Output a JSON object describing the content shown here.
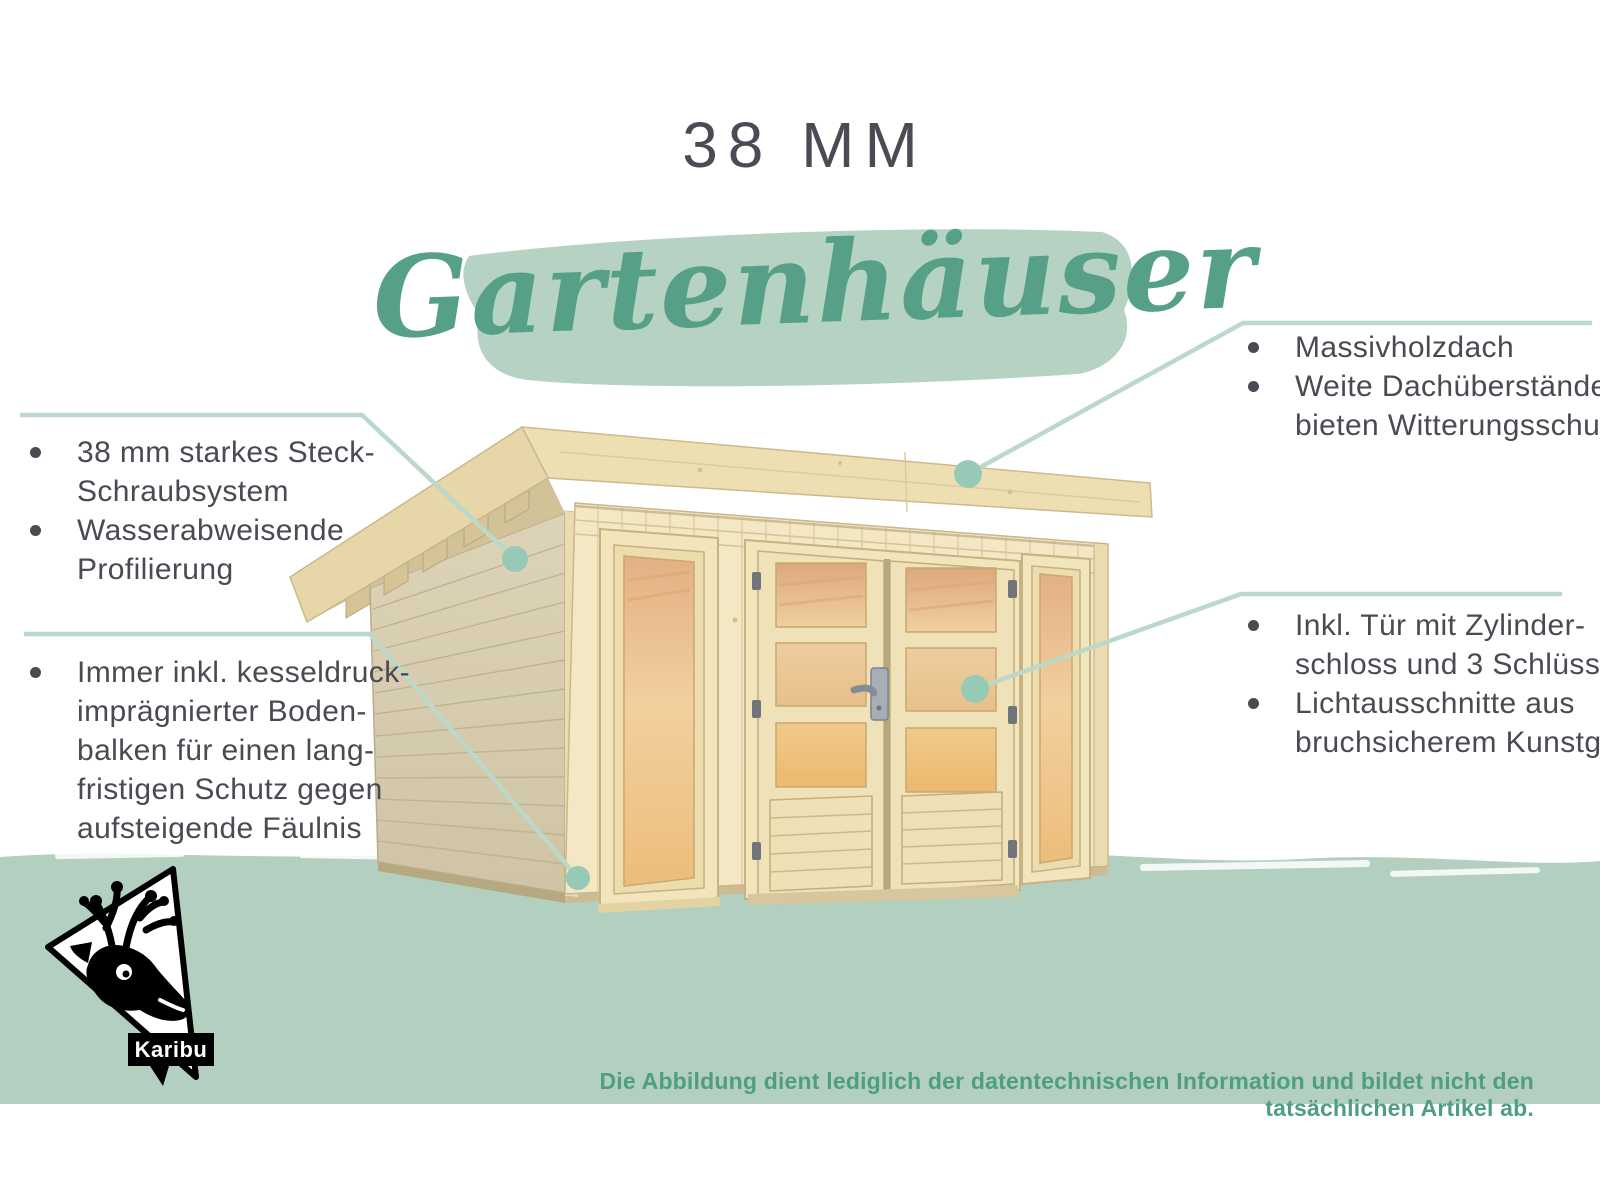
{
  "header": {
    "size_label": "38 MM",
    "script_title": "Gartenhäuser"
  },
  "callouts": {
    "top_left": {
      "lines": [
        "38 mm starkes Steck-",
        "Schraubsystem",
        "Wasserabweisende",
        "Profilierung"
      ]
    },
    "bottom_left": {
      "lines": [
        "Immer inkl. kesseldruck-",
        "imprägnierter Boden-",
        "balken für einen lang-",
        "fristigen Schutz gegen",
        "aufsteigende Fäulnis"
      ]
    },
    "top_right": {
      "lines": [
        "Massivholzdach",
        "Weite Dachüberstände",
        "bieten Witterungsschutz"
      ]
    },
    "bottom_right": {
      "lines": [
        "Inkl. Tür mit Zylinder-",
        "schloss und 3 Schlüsseln",
        "Lichtausschnitte aus",
        "bruchsicherem Kunstglas"
      ]
    }
  },
  "footer": {
    "disclaimer": "Die Abbildung dient lediglich der datentechnischen Information und bildet nicht den tatsächlichen Artikel ab."
  },
  "logo": {
    "label": "Karibu",
    "icon": "karibu-deer-icon"
  },
  "colors": {
    "accent_green": "#55a086",
    "ground_band": "#b2cfc0",
    "brush_band": "#b5d2c2",
    "callout_line": "#bcd8c8",
    "callout_dot": "#97c9b7",
    "text_dark": "#4b4952",
    "disclaimer_green": "#4f9e80",
    "wood_light": "#f4e8c4"
  },
  "illustration": {
    "subject": "wooden flat-roof garden house with glazed double door and two tall windows"
  }
}
